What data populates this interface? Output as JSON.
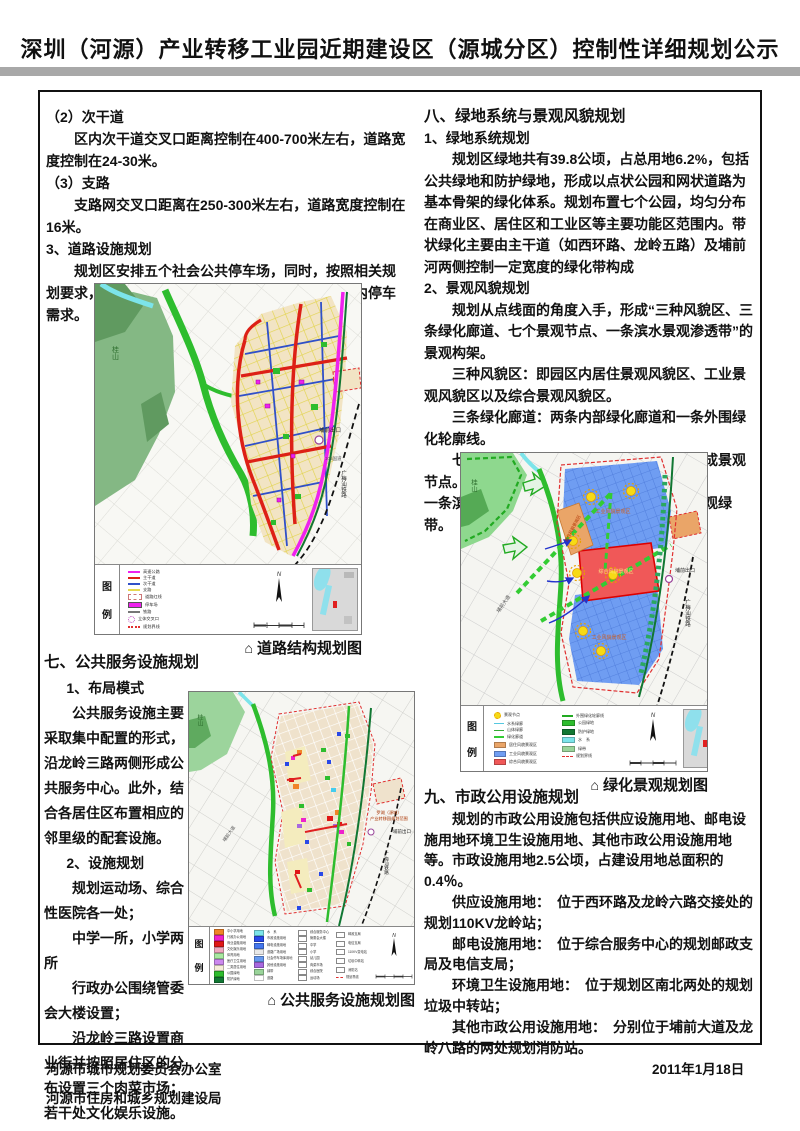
{
  "title": "深圳（河源）产业转移工业园近期建设区（源城分区）控制性详细规划公示",
  "captions": {
    "marker": "⌂",
    "map1": "道路结构规划图",
    "map2": "绿化景观规划图",
    "map3": "公共服务设施规划图"
  },
  "left": {
    "p1": "（2）次干道",
    "p2": "区内次干道交叉口距离控制在400-700米左右，道路宽度控制在24-30米。",
    "p3": "（3）支路",
    "p4": "支路网交叉口距离在250-300米左右，道路宽度控制在16米。",
    "p5": "3、道路设施规划",
    "p6": "规划区安排五个社会公共停车场，同时，按照相关规划要求，各功能地块配建足够的停车场，以解决区内停车需求。",
    "s7_heading": "七、公共服务设施规划",
    "s7p1": "1、布局模式",
    "s7p2": "公共服务设施主要采取集中配置的形式，沿龙岭三路两侧形成公共服务中心。此外，结合各居住区布置相应的邻里级的配套设施。",
    "s7p3": "2、设施规划",
    "s7p4": "规划运动场、综合性医院各一处；",
    "s7p5": "中学一所，小学两所",
    "s7p6": "行政办公围绕管委会大楼设置；",
    "s7p7": "沿龙岭三路设置商业街并按照居住区的分布设置三个肉菜市场；若干处文化娱乐设施。"
  },
  "right": {
    "s8_heading": "八、绿地系统与景观风貌规划",
    "s8sub1": "1、绿地系统规划",
    "s8p1": "规划区绿地共有39.8公顷，占总用地6.2%，包括公共绿地和防护绿地，形成以点状公园和网状道路为基本骨架的绿化体系。规划布置七个公园，均匀分布在商业区、居住区和工业区等主要功能区范围内。带状绿化主要由主干道（如西环路、龙岭五路）及埔前河两侧控制一定宽度的绿化带构成",
    "s8sub2": "2、景观风貌规划",
    "s8p2": "规划从点线面的角度入手，形成“三种风貌区、三条绿化廊道、七个景观节点、一条滨水景观渗透带”的景观构架。",
    "s8p3": "三种风貌区：即园区内居住景观风貌区、工业景观风貌区以及综合景观风貌区。",
    "s8p4": "三条绿化廊道：两条内部绿化廊道和一条外围绿化轮廓线。",
    "s8p5": "七个景观节点：依托七个集中公园绿地形成景观节点。",
    "s8p6": "一条滨水景观渗透带：沿埔前河两岸布置的景观绿带。",
    "s9_heading": "九、市政公用设施规划",
    "s9p1": "规划的市政公用设施包括供应设施用地、邮电设施用地环境卫生设施用地、其他市政公用设施用地等。市政设施用地2.5公顷，占建设用地总面积的0.4％。",
    "s9p2": "供应设施用地：　位于西环路及龙岭六路交接处的规划110KV龙岭站；",
    "s9p3": "邮电设施用地：　位于综合服务中心的规划邮政支局及电信支局；",
    "s9p4": "环境卫生设施用地：　位于规划区南北两处的规划垃圾中转站；",
    "s9p5": "其他市政公用设施用地：　分别位于埔前大道及龙岭八路的两处规划消防站。"
  },
  "footer": {
    "org1": "河源市城市规划委员会办公室",
    "org2": "河源市住房和城乡规划建设局",
    "date": "2011年1月18日"
  },
  "maps": {
    "map1": {
      "legend_title": [
        "图",
        "例"
      ],
      "labels": {
        "mountain": "桂山",
        "exit": "埔前出口",
        "road": "105国道",
        "railway": "广梅汕铁路"
      },
      "legend": [
        {
          "label": "高速公路",
          "color": "#ee22ee",
          "type": "line"
        },
        {
          "label": "主干道",
          "color": "#dd2016",
          "type": "line"
        },
        {
          "label": "次干道",
          "color": "#3050c8",
          "type": "line"
        },
        {
          "label": "支路",
          "color": "#e6d84e",
          "type": "line"
        },
        {
          "label": "道路红线",
          "color": "#ffffff",
          "type": "box"
        },
        {
          "label": "停车场",
          "color": "#ee22ee",
          "type": "square"
        },
        {
          "label": "铁路",
          "color": "#777777",
          "type": "dash"
        },
        {
          "label": "立体交叉口",
          "color": "#bb44bb",
          "type": "circle"
        },
        {
          "label": "规划界线",
          "color": "#e03030",
          "type": "dots"
        }
      ]
    },
    "map2": {
      "legend_title": [
        "图",
        "例"
      ],
      "labels": {
        "mountain": "桂山",
        "zone_ind_n": "工业风貌景观区",
        "zone_comp": "综合风貌景观区",
        "zone_res": "居住风貌景观区",
        "zone_ind_s": "工业风貌景观区",
        "exit": "埔前出口",
        "avenue": "埔前大道",
        "railway": "广梅汕铁路"
      },
      "legend_left": [
        {
          "label": "景观节点",
          "color": "#f6da16",
          "type": "sun"
        },
        {
          "label": "水系绿廊",
          "color": "#55c8e0",
          "type": "wave"
        },
        {
          "label": "山体绿廊",
          "color": "#33aa33",
          "type": "wave"
        },
        {
          "label": "绿化廊道",
          "color": "#33cc33",
          "type": "dash"
        },
        {
          "label": "居住风貌景观区",
          "color": "#eaa568",
          "type": "fill"
        },
        {
          "label": "工业风貌景观区",
          "color": "#6f9df2",
          "type": "fill"
        },
        {
          "label": "综合风貌景观区",
          "color": "#f05858",
          "type": "fill"
        }
      ],
      "legend_right": [
        {
          "label": "外围绿化轮廓线",
          "color": "#22aa22",
          "type": "dash"
        },
        {
          "label": "公园绿地",
          "color": "#2ebd2e",
          "type": "fill"
        },
        {
          "label": "防护绿地",
          "color": "#117733",
          "type": "fill"
        },
        {
          "label": "水　系",
          "color": "#7ce4ea",
          "type": "fill"
        },
        {
          "label": "绿带",
          "color": "#9ad49a",
          "type": "fill"
        },
        {
          "label": "规划界线",
          "color": "#e03030",
          "type": "dashdot"
        }
      ]
    },
    "map3": {
      "legend_title": [
        "图",
        "例"
      ],
      "labels": {
        "mountain": "桂山",
        "callout1": "罗湖（源城）",
        "callout2": "产业转移园规划范围",
        "exit": "埔前出口",
        "avenue": "埔前大道",
        "railway": "广梅汕铁路"
      },
      "legend_col1": [
        {
          "label": "中小学用地",
          "color": "#f08428",
          "type": "fill"
        },
        {
          "label": "行政办公用地",
          "color": "#ee22cc",
          "type": "fill"
        },
        {
          "label": "商业金融用地",
          "color": "#e01616",
          "type": "fill"
        },
        {
          "label": "文化娱乐用地",
          "color": "#f0a8c0",
          "type": "fill"
        },
        {
          "label": "体育用地",
          "color": "#a8e8a0",
          "type": "fill"
        },
        {
          "label": "医疗卫生用地",
          "color": "#cc88ee",
          "type": "fill"
        },
        {
          "label": "二类居住用地",
          "color": "#f5edd8",
          "type": "fill"
        },
        {
          "label": "公园绿地",
          "color": "#2ebd2e",
          "type": "fill"
        },
        {
          "label": "防护绿地",
          "color": "#117733",
          "type": "fill"
        }
      ],
      "legend_col2": [
        {
          "label": "水　系",
          "color": "#7ce4ea",
          "type": "fill"
        },
        {
          "label": "市政设施用地",
          "color": "#2848e8",
          "type": "fill"
        },
        {
          "label": "邮电设施用地",
          "color": "#4477ee",
          "type": "fill"
        },
        {
          "label": "道路广场用地",
          "color": "#e8e8e8",
          "type": "fill"
        },
        {
          "label": "社会停车场库用地",
          "color": "#6699ee",
          "type": "fill"
        },
        {
          "label": "其他设施用地",
          "color": "#a868e0",
          "type": "fill"
        },
        {
          "label": "绿带",
          "color": "#9ad49a",
          "type": "fill"
        },
        {
          "label": "道路",
          "color": "#ffffff",
          "type": "fill"
        }
      ],
      "legend_col3": [
        {
          "label": "综合服务中心",
          "type": "tag"
        },
        {
          "label": "管委会大楼",
          "type": "tag"
        },
        {
          "label": "中学",
          "type": "tag"
        },
        {
          "label": "小学",
          "type": "tag"
        },
        {
          "label": "幼儿园",
          "type": "tag"
        },
        {
          "label": "肉菜市场",
          "type": "tag"
        },
        {
          "label": "综合医院",
          "type": "tag"
        },
        {
          "label": "运动场",
          "type": "tag"
        }
      ],
      "legend_col4": [
        {
          "label": "邮政支局",
          "type": "tag"
        },
        {
          "label": "电信支局",
          "type": "tag"
        },
        {
          "label": "110KV变电站",
          "type": "tag"
        },
        {
          "label": "垃圾中转站",
          "type": "tag"
        },
        {
          "label": "消防站",
          "type": "tag"
        },
        {
          "label": "规划界线",
          "color": "#e03030",
          "type": "dashdot"
        }
      ]
    }
  }
}
